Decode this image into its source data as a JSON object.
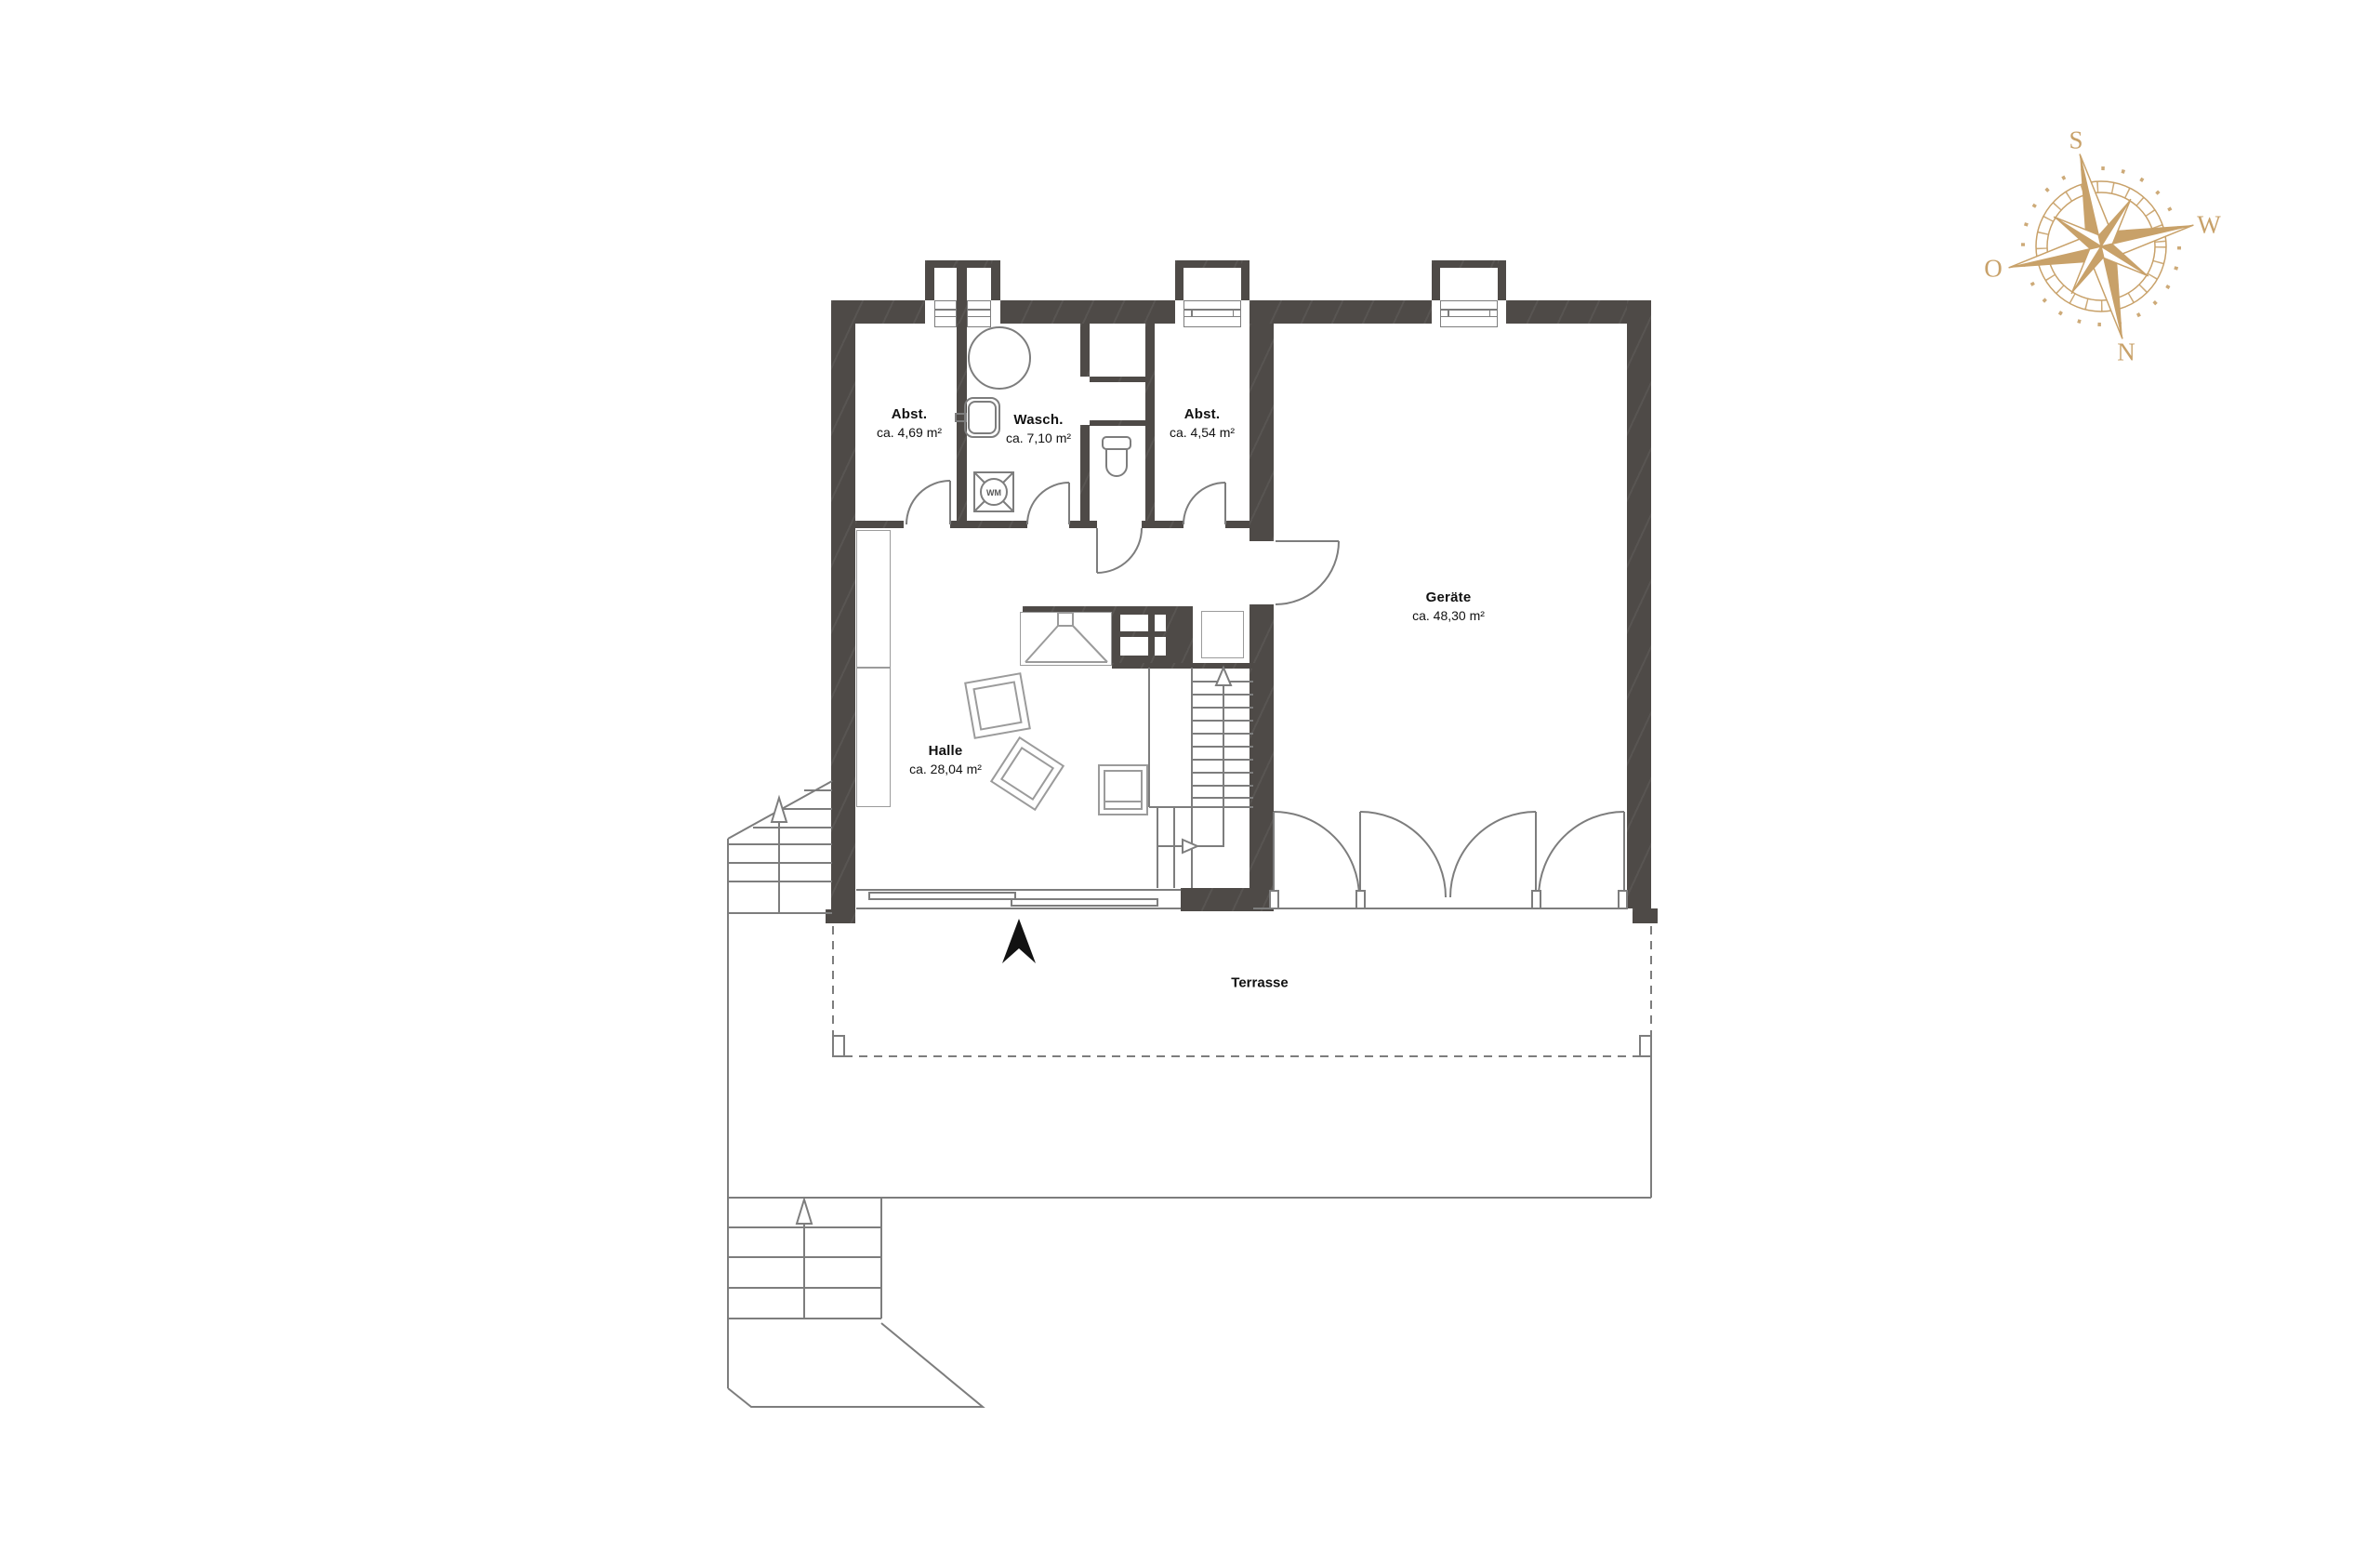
{
  "plan": {
    "rooms": [
      {
        "key": "abst_left",
        "name": "Abst.",
        "area": "ca. 4,69 m²"
      },
      {
        "key": "wasch",
        "name": "Wasch.",
        "area": "ca. 7,10 m²"
      },
      {
        "key": "abst_right",
        "name": "Abst.",
        "area": "ca. 4,54 m²"
      },
      {
        "key": "geraete",
        "name": "Geräte",
        "area": "ca. 48,30 m²"
      },
      {
        "key": "halle",
        "name": "Halle",
        "area": "ca. 28,04 m²"
      }
    ],
    "outdoor": {
      "terrace_label": "Terrasse"
    },
    "appliances": {
      "washing_machine_label": "WM"
    }
  },
  "compass": {
    "points": {
      "south": "S",
      "west": "W",
      "north": "N",
      "east": "O"
    }
  },
  "colors": {
    "wall": "#4e4a47",
    "thin_line": "#7d7d7d",
    "furniture_line": "#9b9b9b",
    "compass": "#c8a169",
    "north_arrow": "#121212",
    "text": "#111111"
  }
}
